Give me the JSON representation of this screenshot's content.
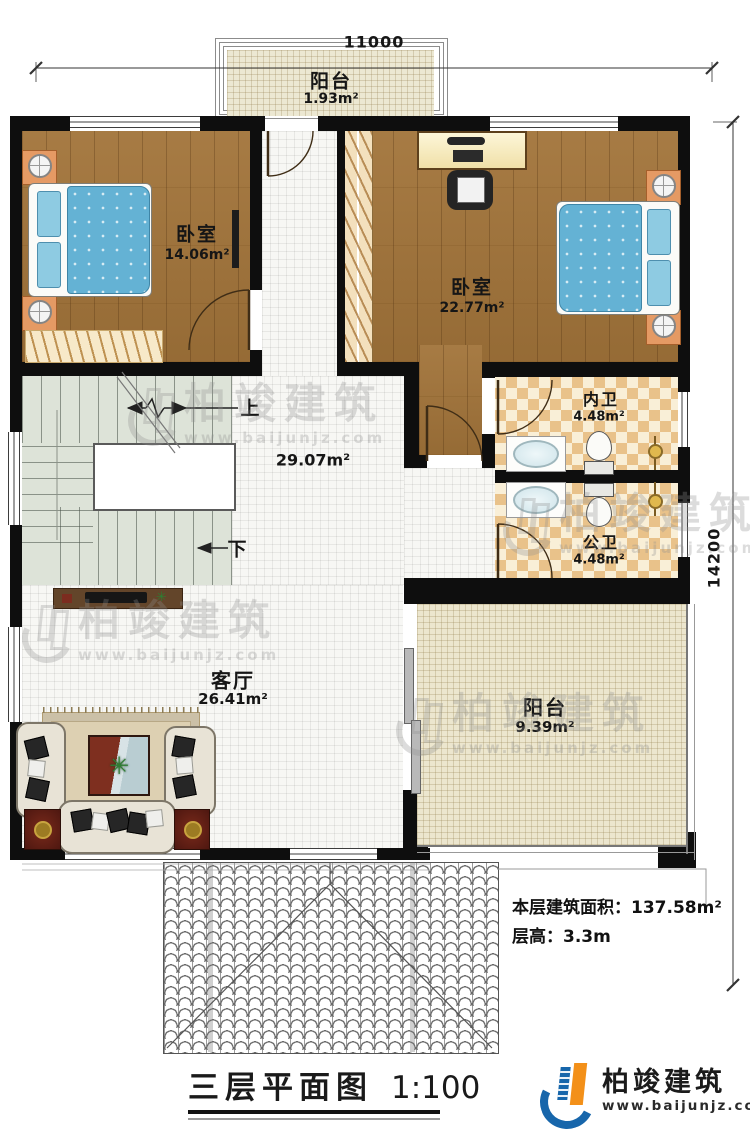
{
  "dimensions": {
    "top": "11000",
    "right": "14200"
  },
  "rooms": {
    "balcony_top": {
      "name": "阳台",
      "area": "1.93m²"
    },
    "bedroom_left": {
      "name": "卧室",
      "area": "14.06m²"
    },
    "bedroom_right": {
      "name": "卧室",
      "area": "22.77m²"
    },
    "bath_private": {
      "name": "内卫",
      "area": "4.48m²"
    },
    "bath_public": {
      "name": "公卫",
      "area": "4.48m²"
    },
    "hall": {
      "area": "29.07m²"
    },
    "living": {
      "name": "客厅",
      "area": "26.41m²"
    },
    "balcony_bottom": {
      "name": "阳台",
      "area": "9.39m²"
    }
  },
  "stairs": {
    "up": "上",
    "down": "下"
  },
  "notes": {
    "area_label": "本层建筑面积：",
    "area_value": "137.58m²",
    "height_label": "层高：",
    "height_value": "3.3m"
  },
  "title": {
    "name": "三层平面图",
    "scale": "1:100"
  },
  "branding": {
    "company": "柏竣建筑",
    "website": "www.baijunjz.com"
  },
  "watermark": {
    "text": "柏竣建筑",
    "url": "www.baijunjz.com"
  }
}
